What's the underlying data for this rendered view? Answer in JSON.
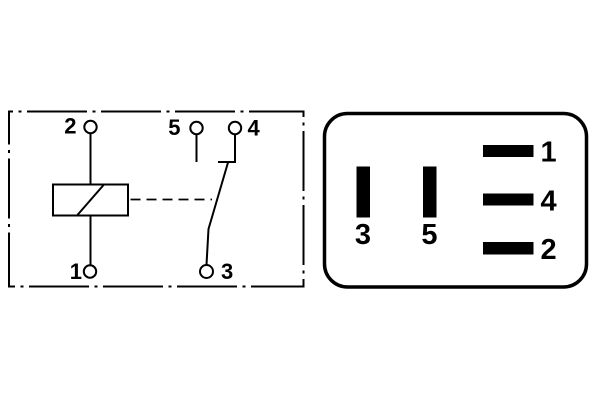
{
  "colors": {
    "line": "#000000",
    "background": "#ffffff",
    "pin_fill": "#000000"
  },
  "schematic": {
    "terminal_labels": {
      "t1": "1",
      "t2": "2",
      "t3": "3",
      "t4": "4",
      "t5": "5"
    }
  },
  "socket": {
    "vertical_pins": [
      {
        "label": "3"
      },
      {
        "label": "5"
      }
    ],
    "horizontal_pins": [
      {
        "label": "1"
      },
      {
        "label": "4"
      },
      {
        "label": "2"
      }
    ]
  }
}
